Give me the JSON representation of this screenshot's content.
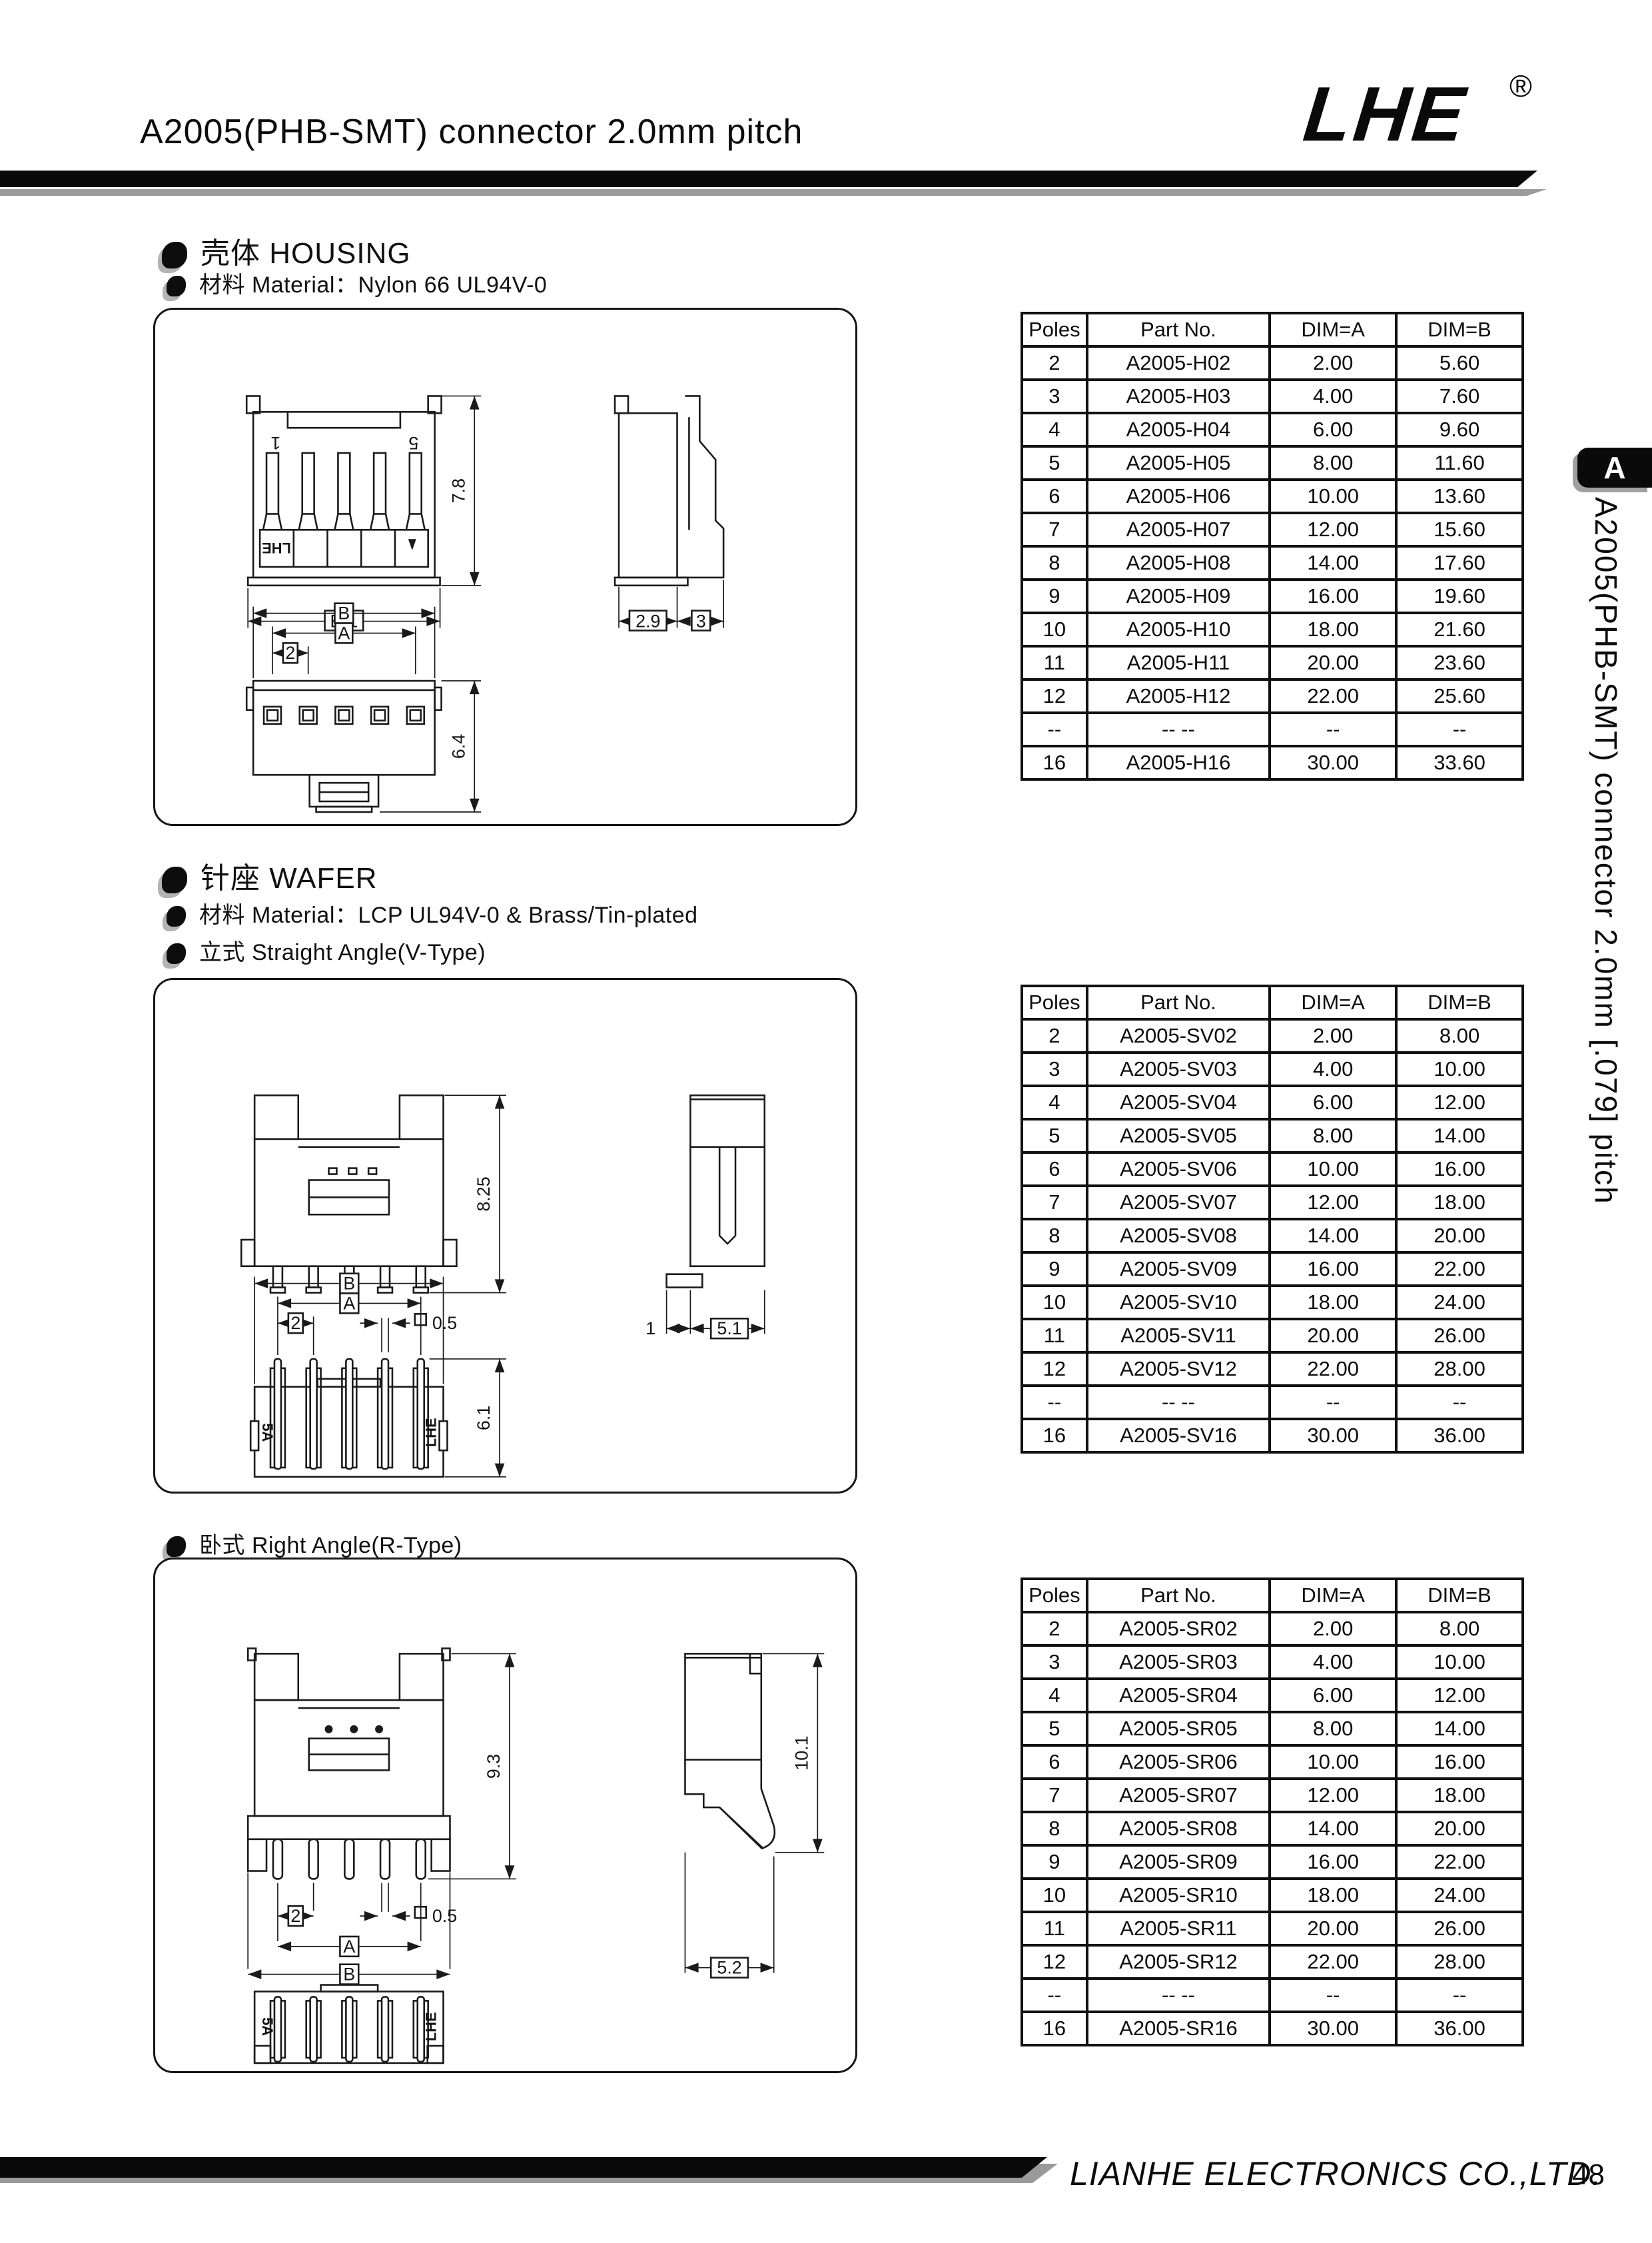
{
  "page": {
    "title": "A2005(PHB-SMT) connector 2.0mm pitch",
    "logo": {
      "text": "LHE",
      "registered": "®"
    },
    "side_tab": {
      "label": "A",
      "vertical_text": "A2005(PHB-SMT) connector 2.0mm [.079] pitch"
    },
    "footer": {
      "company": "LIANHE ELECTRONICS CO.,LTD.",
      "page_number": "48"
    }
  },
  "sections": {
    "housing": {
      "heading": "壳体 HOUSING",
      "material": "材料 Material：Nylon 66 UL94V-0"
    },
    "wafer": {
      "heading": "针座 WAFER",
      "material": "材料 Material：LCP UL94V-0 & Brass/Tin-plated",
      "straight": "立式 Straight Angle(V-Type)",
      "right_angle": "卧式 Right Angle(R-Type)"
    }
  },
  "tables": {
    "columns": [
      "Poles",
      "Part No.",
      "DIM=A",
      "DIM=B"
    ],
    "housing": {
      "rows": [
        [
          "2",
          "A2005-H02",
          "2.00",
          "5.60"
        ],
        [
          "3",
          "A2005-H03",
          "4.00",
          "7.60"
        ],
        [
          "4",
          "A2005-H04",
          "6.00",
          "9.60"
        ],
        [
          "5",
          "A2005-H05",
          "8.00",
          "11.60"
        ],
        [
          "6",
          "A2005-H06",
          "10.00",
          "13.60"
        ],
        [
          "7",
          "A2005-H07",
          "12.00",
          "15.60"
        ],
        [
          "8",
          "A2005-H08",
          "14.00",
          "17.60"
        ],
        [
          "9",
          "A2005-H09",
          "16.00",
          "19.60"
        ],
        [
          "10",
          "A2005-H10",
          "18.00",
          "21.60"
        ],
        [
          "11",
          "A2005-H11",
          "20.00",
          "23.60"
        ],
        [
          "12",
          "A2005-H12",
          "22.00",
          "25.60"
        ],
        [
          "--",
          "-- --",
          "--",
          "--"
        ],
        [
          "16",
          "A2005-H16",
          "30.00",
          "33.60"
        ]
      ]
    },
    "wafer_v": {
      "rows": [
        [
          "2",
          "A2005-SV02",
          "2.00",
          "8.00"
        ],
        [
          "3",
          "A2005-SV03",
          "4.00",
          "10.00"
        ],
        [
          "4",
          "A2005-SV04",
          "6.00",
          "12.00"
        ],
        [
          "5",
          "A2005-SV05",
          "8.00",
          "14.00"
        ],
        [
          "6",
          "A2005-SV06",
          "10.00",
          "16.00"
        ],
        [
          "7",
          "A2005-SV07",
          "12.00",
          "18.00"
        ],
        [
          "8",
          "A2005-SV08",
          "14.00",
          "20.00"
        ],
        [
          "9",
          "A2005-SV09",
          "16.00",
          "22.00"
        ],
        [
          "10",
          "A2005-SV10",
          "18.00",
          "24.00"
        ],
        [
          "11",
          "A2005-SV11",
          "20.00",
          "26.00"
        ],
        [
          "12",
          "A2005-SV12",
          "22.00",
          "28.00"
        ],
        [
          "--",
          "-- --",
          "--",
          "--"
        ],
        [
          "16",
          "A2005-SV16",
          "30.00",
          "36.00"
        ]
      ]
    },
    "wafer_r": {
      "rows": [
        [
          "2",
          "A2005-SR02",
          "2.00",
          "8.00"
        ],
        [
          "3",
          "A2005-SR03",
          "4.00",
          "10.00"
        ],
        [
          "4",
          "A2005-SR04",
          "6.00",
          "12.00"
        ],
        [
          "5",
          "A2005-SR05",
          "8.00",
          "14.00"
        ],
        [
          "6",
          "A2005-SR06",
          "10.00",
          "16.00"
        ],
        [
          "7",
          "A2005-SR07",
          "12.00",
          "18.00"
        ],
        [
          "8",
          "A2005-SR08",
          "14.00",
          "20.00"
        ],
        [
          "9",
          "A2005-SR09",
          "16.00",
          "22.00"
        ],
        [
          "10",
          "A2005-SR10",
          "18.00",
          "24.00"
        ],
        [
          "11",
          "A2005-SR11",
          "20.00",
          "26.00"
        ],
        [
          "12",
          "A2005-SR12",
          "22.00",
          "28.00"
        ],
        [
          "--",
          "-- --",
          "--",
          "--"
        ],
        [
          "16",
          "A2005-SR16",
          "30.00",
          "36.00"
        ]
      ]
    }
  },
  "drawings": {
    "housing": {
      "pin_first": "1",
      "pin_last": "5",
      "brand": "LHE",
      "dim_height": "7.8",
      "dim_width": "B-1",
      "dim_side_a": "2.9",
      "dim_side_b": "3",
      "dim_B": "B",
      "dim_A": "A",
      "dim_pitch": "2",
      "dim_bottom_height": "6.4"
    },
    "wafer_v": {
      "dim_height": "8.25",
      "dim_foot": "1",
      "dim_side_width": "5.1",
      "dim_B": "B",
      "dim_A": "A",
      "dim_pitch": "2",
      "dim_pad": "0.5",
      "dim_bottom_height": "6.1",
      "mark_left": "5A",
      "mark_right": "LHE"
    },
    "wafer_r": {
      "dim_height": "9.3",
      "dim_side_height": "10.1",
      "dim_side_width": "5.2",
      "dim_B": "B",
      "dim_A": "A",
      "dim_pitch": "2",
      "dim_pad": "0.5",
      "mark_left": "5A",
      "mark_right": "LHE"
    }
  }
}
